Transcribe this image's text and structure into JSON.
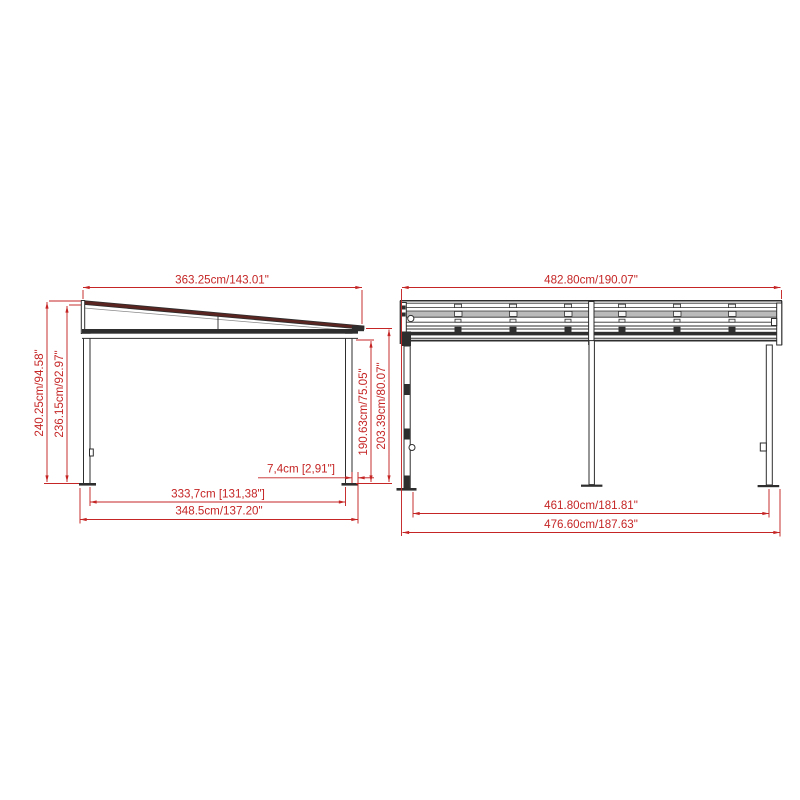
{
  "document": {
    "type": "technical-drawing",
    "subject": "carport with mono-pitched roof, two elevation views"
  },
  "views": {
    "side": {
      "roof_length": "363.25cm/143.01\"",
      "height_high_overall": "240.25cm/94.58\"",
      "height_high_frame": "236.15cm/92.97\"",
      "post_height_low": "190.63cm/75.05\"",
      "height_low_overall": "203.39cm/80.07\"",
      "overhang": "7,4cm [2,91\"]",
      "post_spacing": "333,7cm [131,38\"]",
      "depth_overall": "348.5cm/137.20\""
    },
    "front": {
      "roof_width": "482.80cm/190.07\"",
      "post_spacing": "461.80cm/181.81\"",
      "width_overall": "476.60cm/187.63\""
    }
  },
  "colors": {
    "dimension": "#c52525",
    "structure": "#2e2e2e",
    "roof_fill": "#5a2420",
    "panel": "#a9a9a9"
  }
}
